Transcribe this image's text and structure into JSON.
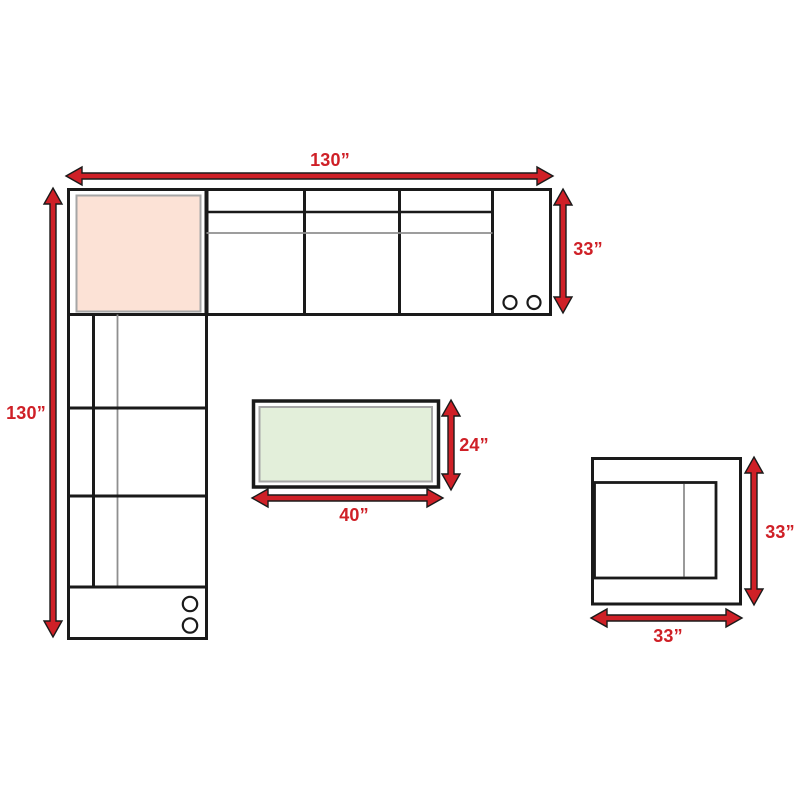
{
  "diagram_type": "furniture-dimension-plan",
  "colors": {
    "accent_red": "#cf2027",
    "outline_dark": "#1a1a1a",
    "detail_gray": "#8f8f8f",
    "corner_cushion_fill": "#fce2d6",
    "table_top_fill": "#e3efda"
  },
  "labels": {
    "sofa_width": "130”",
    "sofa_length": "130”",
    "sofa_depth": "33”",
    "table_depth": "24”",
    "table_width": "40”",
    "chair_depth": "33”",
    "chair_width": "33”"
  }
}
